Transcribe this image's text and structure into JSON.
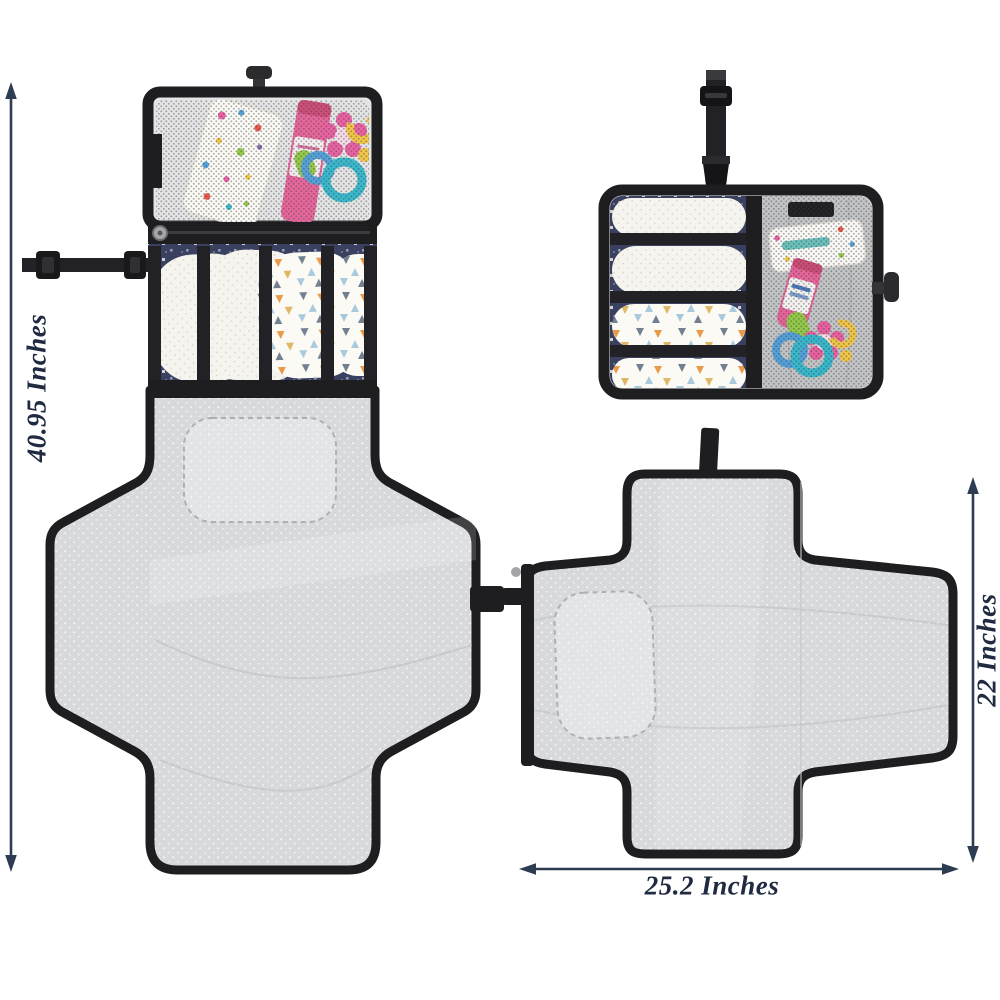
{
  "annotations": {
    "height_label": "40.95 Inches",
    "folded_height_label": "22 Inches",
    "width_label": "25.2 Inches"
  },
  "colors": {
    "page_bg": "#ffffff",
    "annotation_arrow": "#2e3c52",
    "annotation_text": "#202a40",
    "trim_black": "#1e1e21",
    "strap_black": "#222226",
    "mat_gray": "#d7d9db",
    "pillow_gray": "#e2e4e6",
    "mesh_dot": "#333336",
    "fabric_navy": "#3a4160",
    "diaper_white": "#f6f4ee",
    "diaper_dot": "#d8d2c4",
    "tube_pink": "#e55b94",
    "toy_pink": "#e8579b",
    "toy_teal": "#2cb4c9",
    "toy_blue": "#4a9bd6",
    "toy_yellow": "#f1c23c",
    "toy_green": "#8cc63e",
    "tri_orange": "#e89a4a",
    "tri_blue": "#a9c9dd",
    "tri_slate": "#73808f",
    "tri_gold": "#e0b764"
  }
}
